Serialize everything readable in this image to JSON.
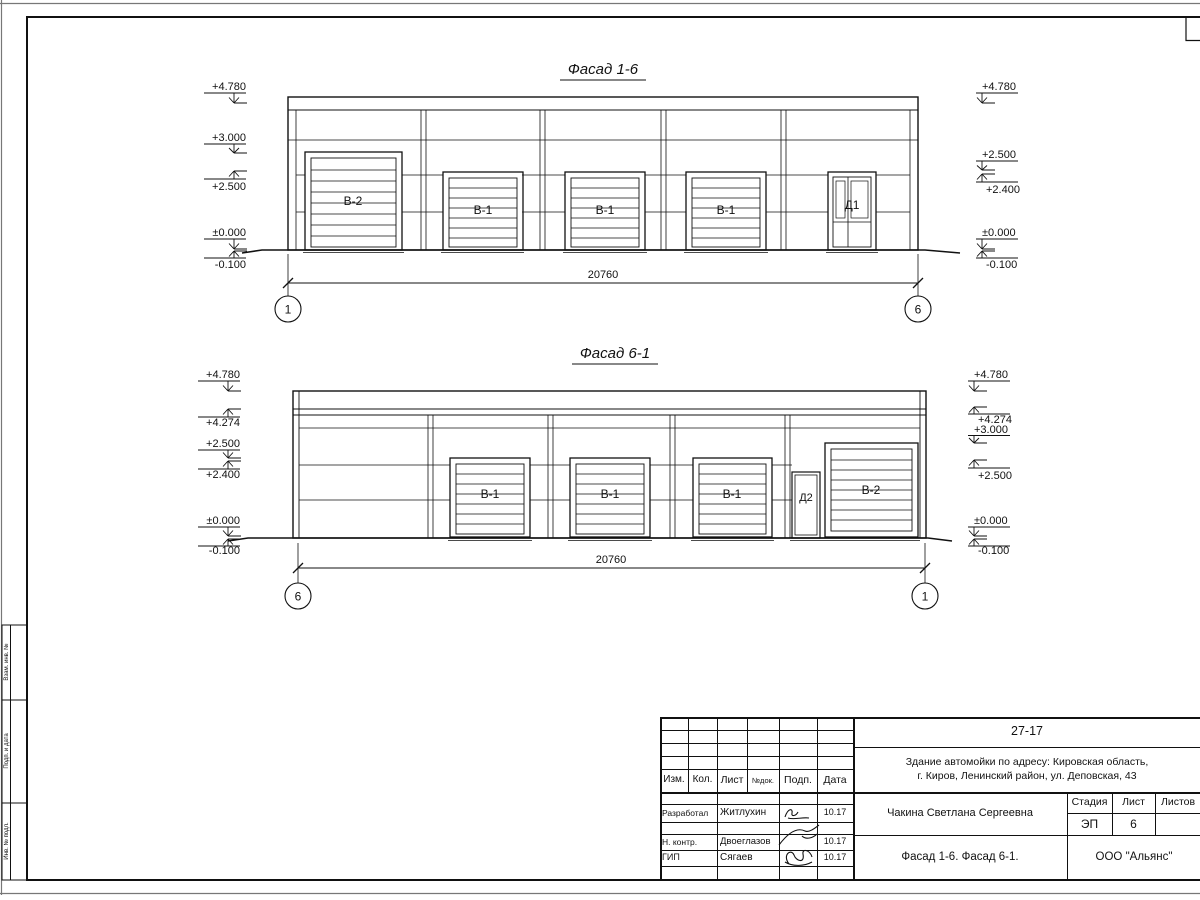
{
  "sheet": {
    "background": "#ffffff",
    "line_color": "#111111"
  },
  "side_stamps": [
    "Взам. инв. №",
    "Подп. и дата",
    "Инв. № подл."
  ],
  "facade_top": {
    "title": "Фасад 1-6",
    "marks_left": [
      "+4.780",
      "+3.000",
      "+2.500",
      "±0.000",
      "-0.100"
    ],
    "marks_right": [
      "+4.780",
      "+2.500",
      "+2.400",
      "±0.000",
      "-0.100"
    ],
    "doors": [
      "В-2",
      "В-1",
      "В-1",
      "В-1",
      "Д1"
    ],
    "dim": "20760",
    "axis_left": "1",
    "axis_right": "6"
  },
  "facade_bottom": {
    "title": "Фасад 6-1",
    "marks_left": [
      "+4.780",
      "+4.274",
      "+2.500",
      "+2.400",
      "±0.000",
      "-0.100"
    ],
    "marks_right": [
      "+4.780",
      "+4.274",
      "+3.000",
      "+2.500",
      "±0.000",
      "-0.100"
    ],
    "doors": [
      "В-1",
      "В-1",
      "В-1",
      "Д2",
      "В-2"
    ],
    "dim": "20760",
    "axis_left": "6",
    "axis_right": "1"
  },
  "title_block": {
    "doc_number": "27-17",
    "address_line1": "Здание автомойки по адресу: Кировская область,",
    "address_line2": "г. Киров, Ленинский район, ул. Деповская, 43",
    "rev_headers": [
      "Изм.",
      "Кол.",
      "Лист",
      "№док.",
      "Подп.",
      "Дата"
    ],
    "staff": [
      {
        "role": "Разработал",
        "name": "Житлухин",
        "date": "10.17"
      },
      {
        "role": "Н. контр.",
        "name": "Двоеглазов",
        "date": "10.17"
      },
      {
        "role": "ГИП",
        "name": "Сягаев",
        "date": "10.17"
      }
    ],
    "customer": "Чакина Светлана Сергеевна",
    "stage_label": "Стадия",
    "sheet_label": "Лист",
    "sheets_label": "Листов",
    "stage": "ЭП",
    "sheet_no": "6",
    "sheets_total": "",
    "drawing_name": "Фасад 1-6. Фасад 6-1.",
    "company": "ООО \"Альянс\""
  }
}
